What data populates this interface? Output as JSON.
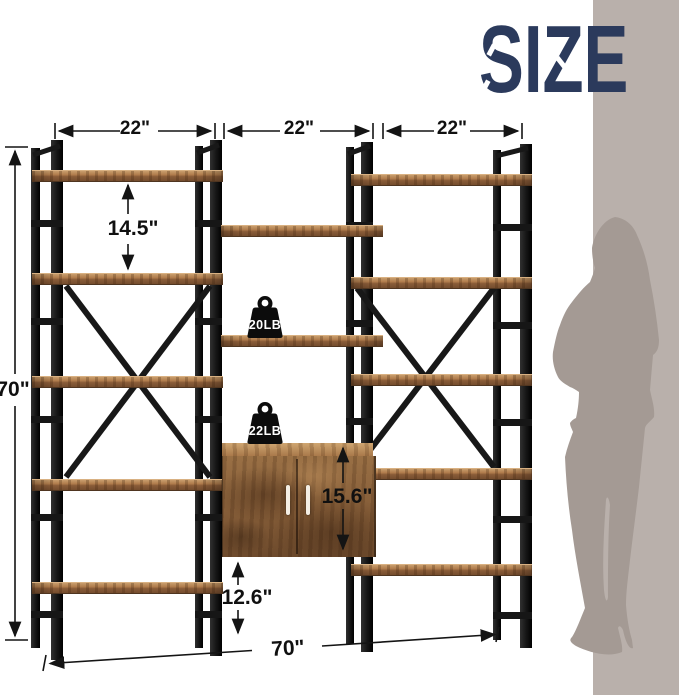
{
  "title": "SIZE",
  "dimensions": {
    "left_section_width": "22\"",
    "middle_section_width": "22\"",
    "right_section_width": "22\"",
    "overall_height": "70\"",
    "shelf_spacing": "14.5\"",
    "cabinet_height": "15.6\"",
    "under_cabinet_clearance": "12.6\"",
    "overall_width": "70\""
  },
  "weights": {
    "shelf_capacity": "20LB",
    "cabinet_capacity": "22LB"
  },
  "icons": {
    "shelf_weight": "kettlebell-icon",
    "cabinet_weight": "kettlebell-icon",
    "scale_figure": "female-silhouette"
  },
  "colors": {
    "headline_navy": "#2b3a5c",
    "frame_black": "#1a1a1a",
    "wood_brown": "#8a5c38",
    "wall_panel_taupe": "#b9b0ab",
    "silhouette_gray": "#a49a94",
    "dimension_line": "#141414"
  }
}
